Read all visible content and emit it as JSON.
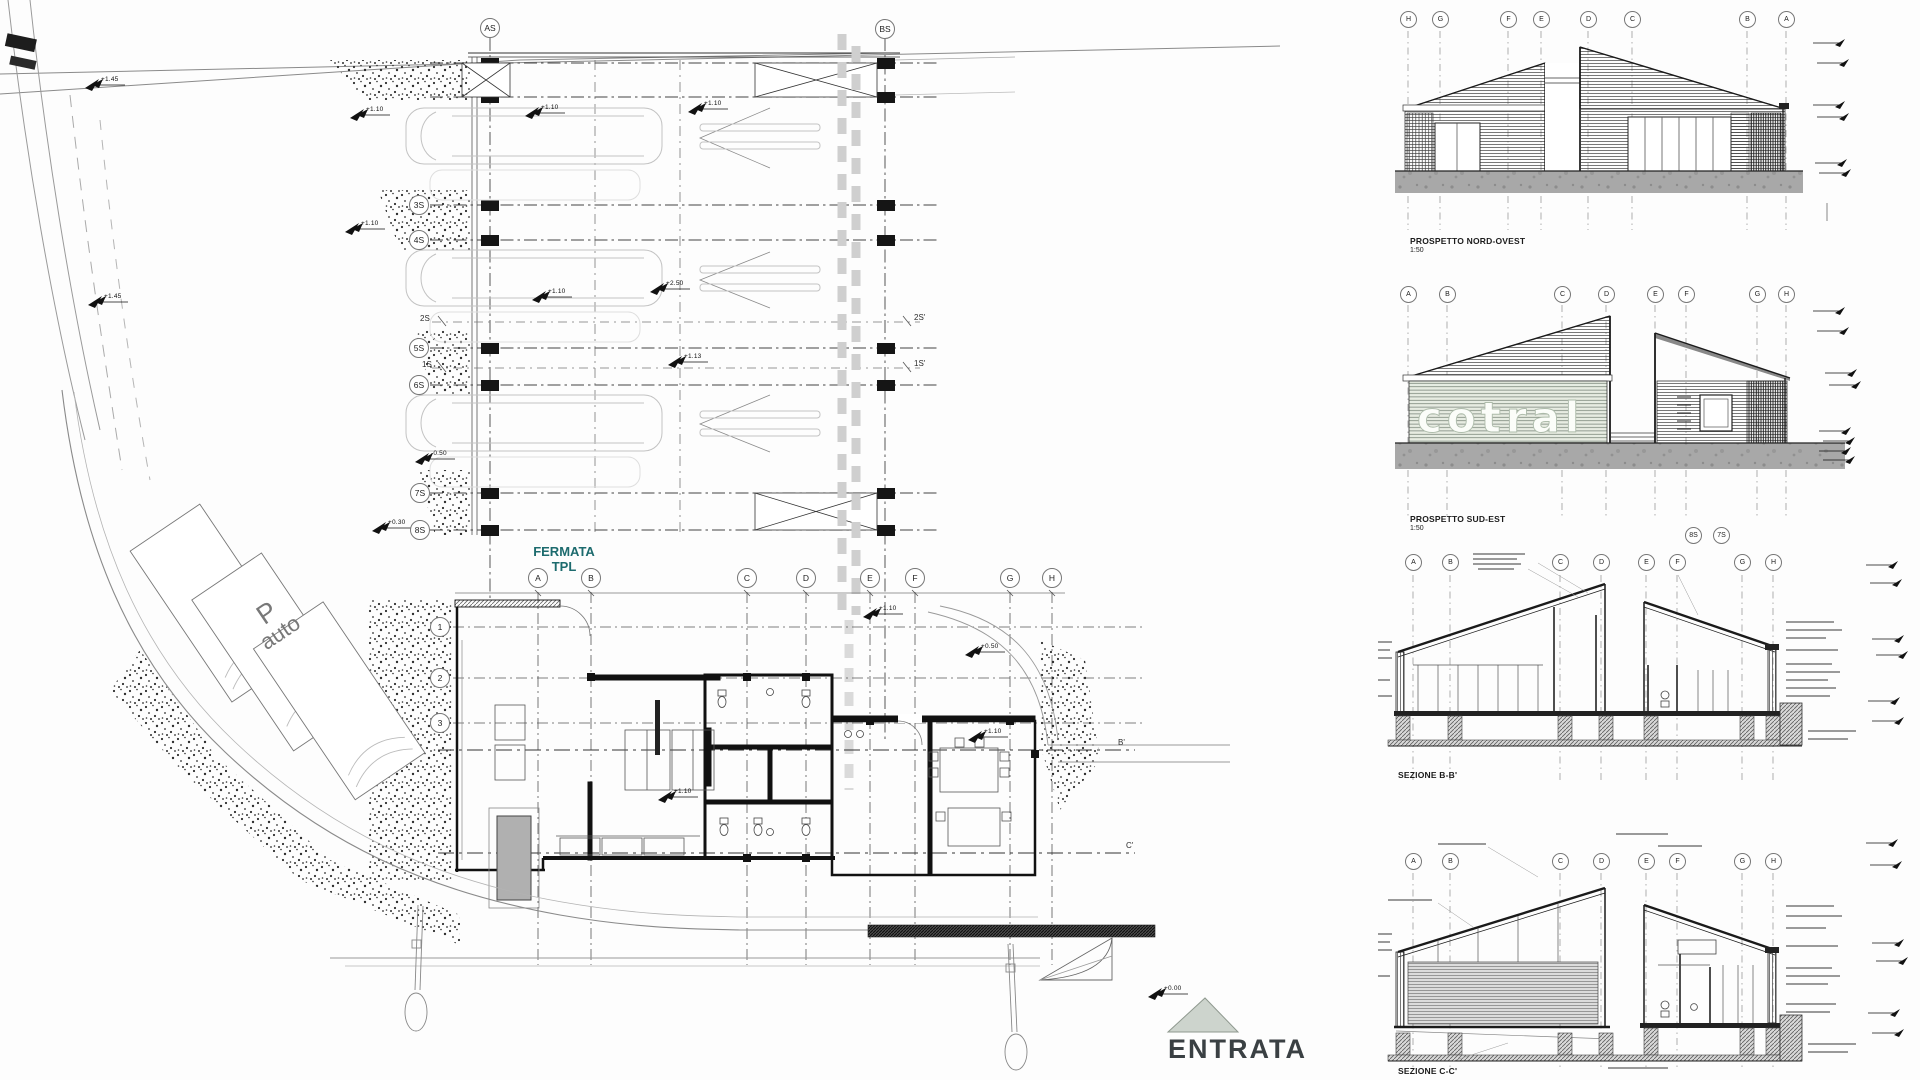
{
  "site_plan": {
    "depot": {
      "col_as": "AS",
      "col_bs": "BS",
      "rows": [
        "3S",
        "4S",
        "5S",
        "6S",
        "7S",
        "8S"
      ],
      "ticks": [
        "2S",
        "1S",
        "2S'",
        "1S'"
      ]
    },
    "building": {
      "letters": [
        "A",
        "B",
        "C",
        "D",
        "E",
        "F",
        "G",
        "H"
      ],
      "numbers": [
        "1",
        "2",
        "3"
      ],
      "section_ticks": [
        "B'",
        "C'"
      ]
    },
    "labels": {
      "fermata_line1": "FERMATA",
      "fermata_line2": "TPL",
      "parking_symbol": "P",
      "parking_text": "auto",
      "entrance": "ENTRATA"
    },
    "spots": [
      "+1.10",
      "+1.10",
      "+1.10",
      "+1.13",
      "+2.50",
      "+1.10",
      "-0.50",
      "+0.30",
      "+1.45",
      "+1.45",
      "+1.10",
      "+0.50",
      "+1.10",
      "+1.10",
      "+0.00",
      "+1.10"
    ]
  },
  "drawings": {
    "nord_ovest": {
      "title": "PROSPETTO NORD-OVEST",
      "scale": "1:50",
      "grid": [
        "H",
        "G",
        "F",
        "E",
        "D",
        "C",
        "B",
        "A"
      ]
    },
    "sud_est": {
      "title": "PROSPETTO SUD-EST",
      "scale": "1:50",
      "logo": "cotral",
      "grid": [
        "A",
        "B",
        "C",
        "D",
        "E",
        "F",
        "G",
        "H"
      ],
      "bubbles": [
        "8S",
        "7S"
      ]
    },
    "sezione_b": {
      "title": "SEZIONE B-B'",
      "grid": [
        "A",
        "B",
        "C",
        "D",
        "E",
        "F",
        "G",
        "H"
      ]
    },
    "sezione_c": {
      "title": "SEZIONE C-C'",
      "grid": [
        "A",
        "B",
        "C",
        "D",
        "E",
        "F",
        "G",
        "H"
      ]
    }
  }
}
